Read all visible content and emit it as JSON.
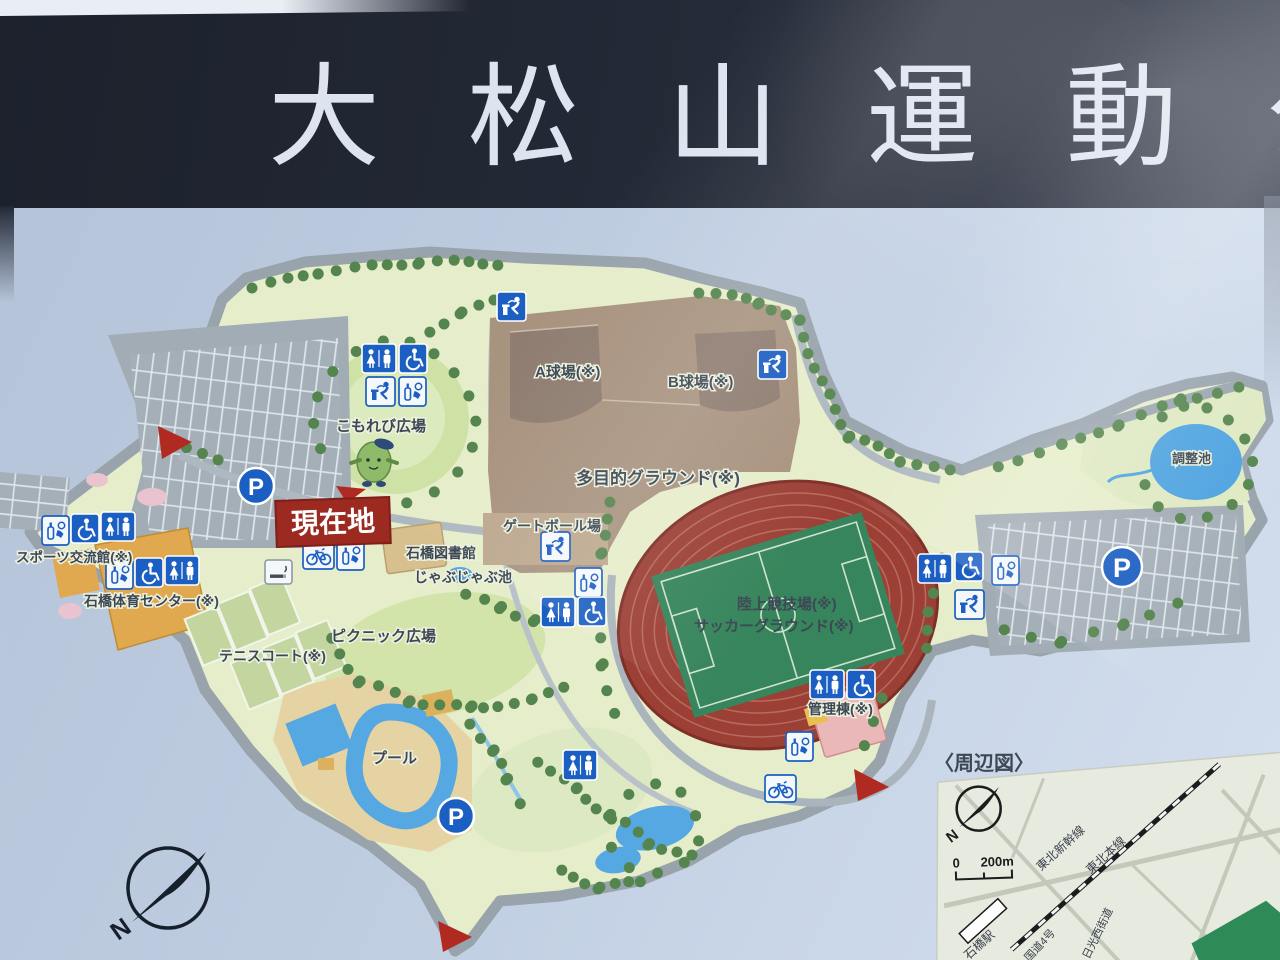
{
  "sign": {
    "title": "大松山運動",
    "title_partial": "公"
  },
  "map": {
    "current_location": "現在地",
    "parking_label": "P",
    "north_label": "N",
    "facilities": [
      {
        "id": "a-field",
        "label": "A球場(※)"
      },
      {
        "id": "b-field",
        "label": "B球場(※)"
      },
      {
        "id": "multi-ground",
        "label": "多目的グラウンド(※)"
      },
      {
        "id": "komorebi",
        "label": "こもれび広場"
      },
      {
        "id": "library",
        "label": "石橋図書館"
      },
      {
        "id": "jabujabu",
        "label": "じゃぶじゃぶ池"
      },
      {
        "id": "gateball",
        "label": "ゲートボール場"
      },
      {
        "id": "sports-hall",
        "label": "スポーツ交流館(※)"
      },
      {
        "id": "gym",
        "label": "石橋体育センター(※)"
      },
      {
        "id": "tennis",
        "label": "テニスコート(※)"
      },
      {
        "id": "picnic",
        "label": "ピクニック広場"
      },
      {
        "id": "pool",
        "label": "プール"
      },
      {
        "id": "athletics",
        "label": "陸上競技場(※)"
      },
      {
        "id": "soccer",
        "label": "サッカーグラウンド(※)"
      },
      {
        "id": "admin",
        "label": "管理棟(※)"
      },
      {
        "id": "pond",
        "label": "調整池"
      }
    ],
    "inset": {
      "heading": "〈周辺図〉",
      "north_label": "N",
      "scale_start": "0",
      "scale_end": "200m",
      "shinkansen": "東北新幹線",
      "mainline": "東北本線",
      "station": "石橋駅",
      "route4": "国道4号",
      "nikko_road": "日光西街道"
    }
  },
  "colors": {
    "header_band": "#242a37",
    "board_blue": "#bfcde1",
    "land": "#e6edca",
    "lawn": "#d2e4aa",
    "ground_brown": "#a8937f",
    "track_red": "#9c4036",
    "field_green": "#37855c",
    "water_blue": "#56a8e2",
    "road_gray": "#9aa5ae",
    "icon_blue": "#1c5fc2",
    "current_red": "#9c2a20"
  }
}
